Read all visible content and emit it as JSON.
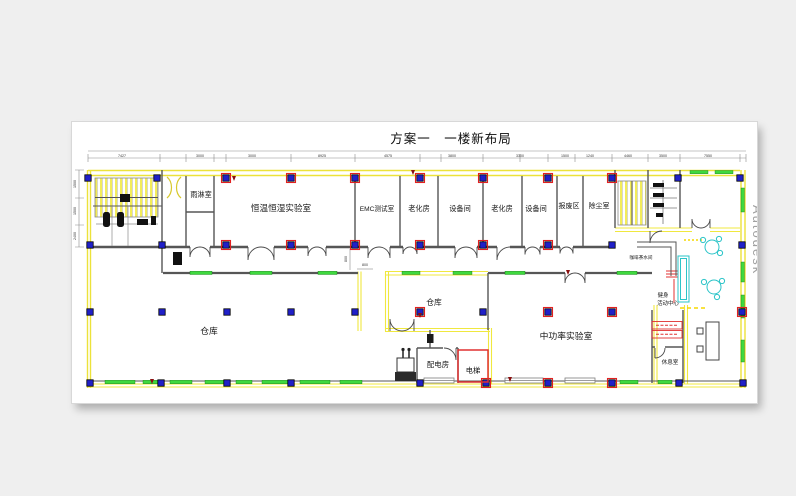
{
  "page": {
    "title": "方案一　一楼新布局",
    "watermark": "Autodesk"
  },
  "rooms": {
    "rain_room": "雨淋室",
    "climate_lab": "恒温恒湿实验室",
    "emc_room": "EMC测试室",
    "aging_room_1": "老化房",
    "equipment_room_1": "设备间",
    "aging_room_2": "老化房",
    "equipment_room_2": "设备间",
    "scrap_area": "报废区",
    "dust_room": "除尘室",
    "warehouse_main": "仓库",
    "warehouse_small": "仓库",
    "power_room": "配电房",
    "elevator": "电梯",
    "mid_power_lab": "中功率实验室",
    "coffee_bar": "咖啡茶水间",
    "fitness_line1": "健身",
    "fitness_line2": "活动中心",
    "lounge": "休息室"
  },
  "dims": {
    "top": [
      "7427",
      "3000",
      "3000",
      "8925",
      "4575",
      "3800",
      "3300"
    ],
    "right": [
      "1500",
      "1240",
      "4460",
      "3500",
      "7550"
    ],
    "left": [
      "1500",
      "1500",
      "2400"
    ],
    "small": [
      "800",
      "800"
    ]
  },
  "colors": {
    "wall_yellow": "#ece23a",
    "window_green": "#3fd93f",
    "column_blue": "#2020c8",
    "highlight_red": "#e03030",
    "furniture_cyan": "#2bc4c8",
    "background": "#efefef",
    "paper": "#ffffff"
  }
}
